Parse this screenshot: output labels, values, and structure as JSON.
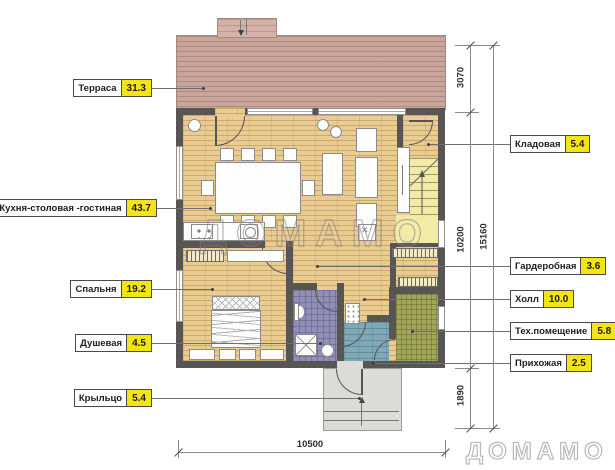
{
  "title": "План первого этажа дома",
  "watermark": {
    "text": "ДОМАМО"
  },
  "labels_left": [
    {
      "name": "Терраса",
      "value": "31.3"
    },
    {
      "name": "Кухня-столовая -гостиная",
      "value": "43.7"
    },
    {
      "name": "Спальня",
      "value": "19.2"
    },
    {
      "name": "Душевая",
      "value": "4.5"
    },
    {
      "name": "Крыльцо",
      "value": "5.4"
    }
  ],
  "labels_right": [
    {
      "name": "Кладовая",
      "value": "5.4"
    },
    {
      "name": "Гардеробная",
      "value": "3.6"
    },
    {
      "name": "Холл",
      "value": "10.0"
    },
    {
      "name": "Тех.помещение",
      "value": "5.8"
    },
    {
      "name": "Прихожая",
      "value": "2.5"
    }
  ],
  "dimensions": {
    "terrace_height": "3070",
    "house_height": "10200",
    "porch_height": "1890",
    "total_height": "15160",
    "total_width": "10500"
  },
  "colors": {
    "area_badge": "#f5e414",
    "wall": "#585654",
    "wood_floor": "#e9cc92",
    "terrace": "#c9a59b",
    "stairs": "#f2eaa6",
    "shower_room": "#928fb6",
    "hallway_room": "#7fa9b4",
    "tech_room": "#a2a55c",
    "porch": "#dbdbd9"
  }
}
